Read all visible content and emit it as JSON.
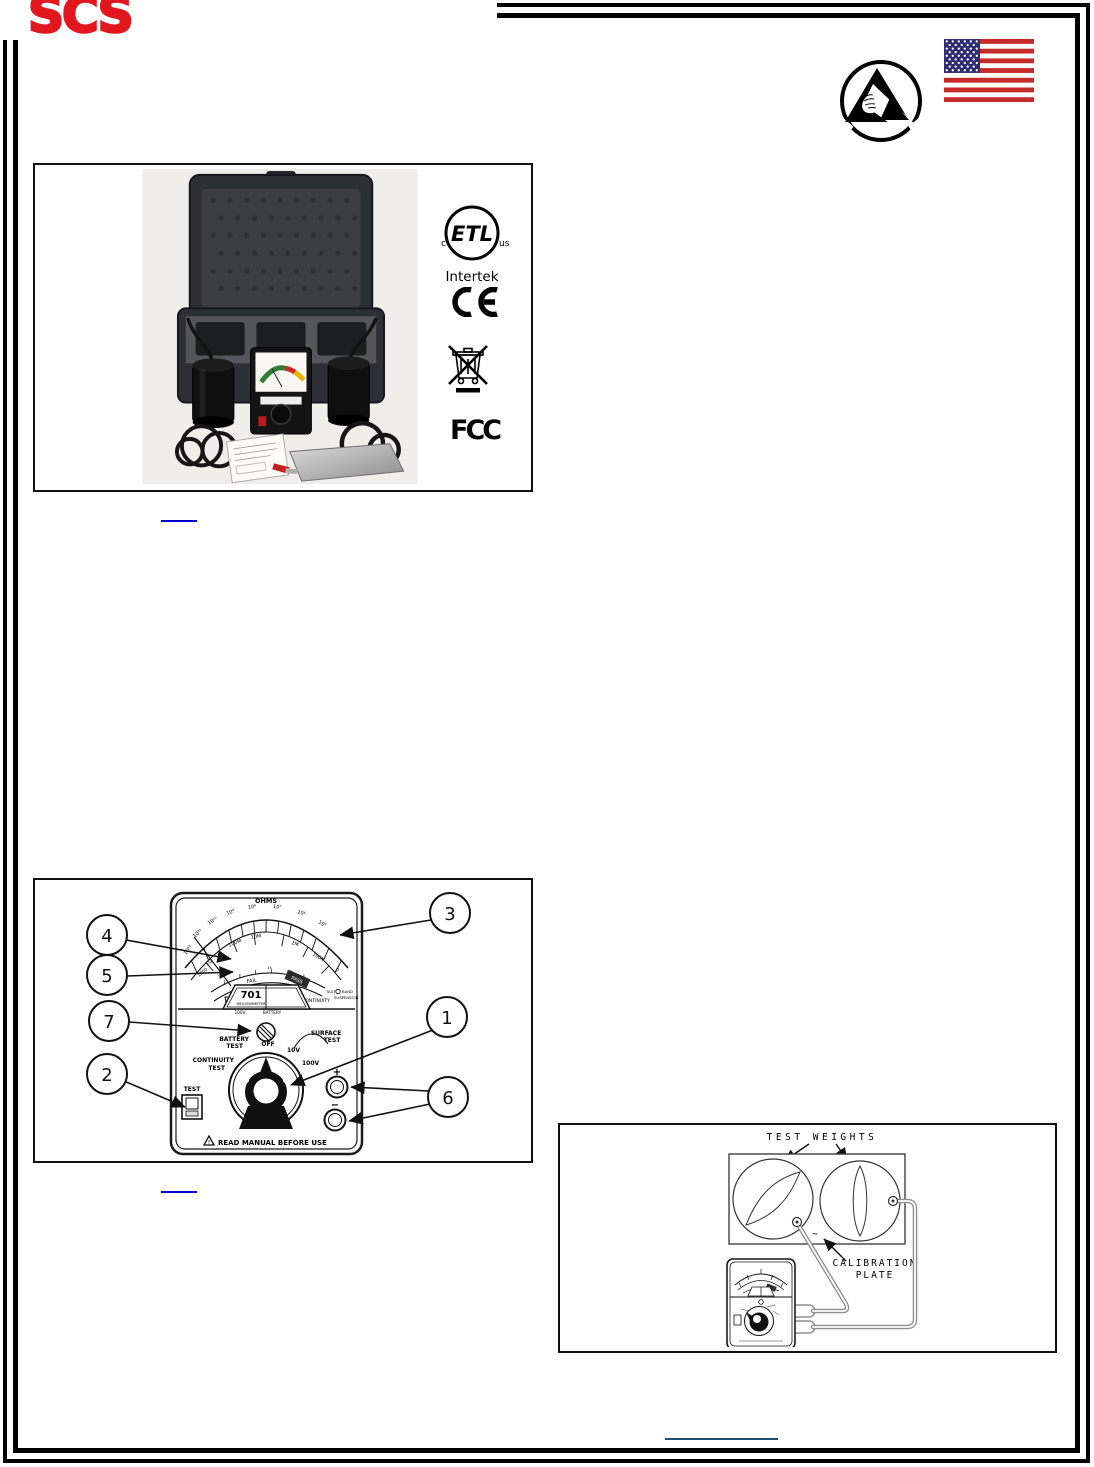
{
  "colors": {
    "logo_red": "#E2171E",
    "link_blue": "#0000CC",
    "footer_link_blue": "#1F4E79",
    "border_black": "#000000"
  },
  "brand": {
    "logo_text": "SCS"
  },
  "icons": {
    "esd": "esd-susceptibility-symbol",
    "flag": "us-flag",
    "etl": "etl-intertek-mark",
    "ce": "ce-mark",
    "weee": "weee-crossed-out-bin",
    "fcc": "fcc-mark"
  },
  "figure1": {
    "certifications": {
      "etl": {
        "label": "ETL",
        "left_mark": "c",
        "right_mark": "us",
        "company": "Intertek"
      },
      "fcc_label": "FCC"
    }
  },
  "figure2": {
    "callouts": {
      "c1": "1",
      "c2": "2",
      "c3": "3",
      "c4": "4",
      "c5": "5",
      "c6": "6",
      "c7": "7"
    },
    "meter": {
      "title": "OHMS",
      "outer_scale": [
        "10¹²",
        "10¹¹",
        "10¹⁰",
        "10⁹",
        "10⁸",
        "10⁷",
        "10⁶",
        "10⁵"
      ],
      "mid_scale": [
        "1G",
        "100M",
        "10M",
        "1M",
        "100K",
        "0"
      ],
      "left_value": "1000",
      "battery_tick": "14",
      "fail_label": "FAIL",
      "pass_label": "PASS",
      "voltage_window": "100V",
      "battery_window": "BATTERY",
      "continuity_label": "CONTINUITY",
      "model_number": "701",
      "model_name": "MEGOHMMETER",
      "suspension": {
        "w1": "TAUT",
        "w2": "BAND",
        "w3": "SUSPENSION"
      },
      "dial": {
        "battery_1": "BATTERY",
        "battery_2": "TEST",
        "off": "OFF",
        "v10": "10V",
        "v100": "100V",
        "surface_1": "SURFACE",
        "surface_2": "TEST",
        "continuity_1": "CONTINUITY",
        "continuity_2": "TEST"
      },
      "test_switch_label": "TEST",
      "jack_plus": "+",
      "jack_minus": "−",
      "warning_text": "READ MANUAL BEFORE USE"
    }
  },
  "figure3": {
    "weights_label": "TEST WEIGHTS",
    "plate_label_1": "CALIBRATION",
    "plate_label_2": "PLATE"
  }
}
